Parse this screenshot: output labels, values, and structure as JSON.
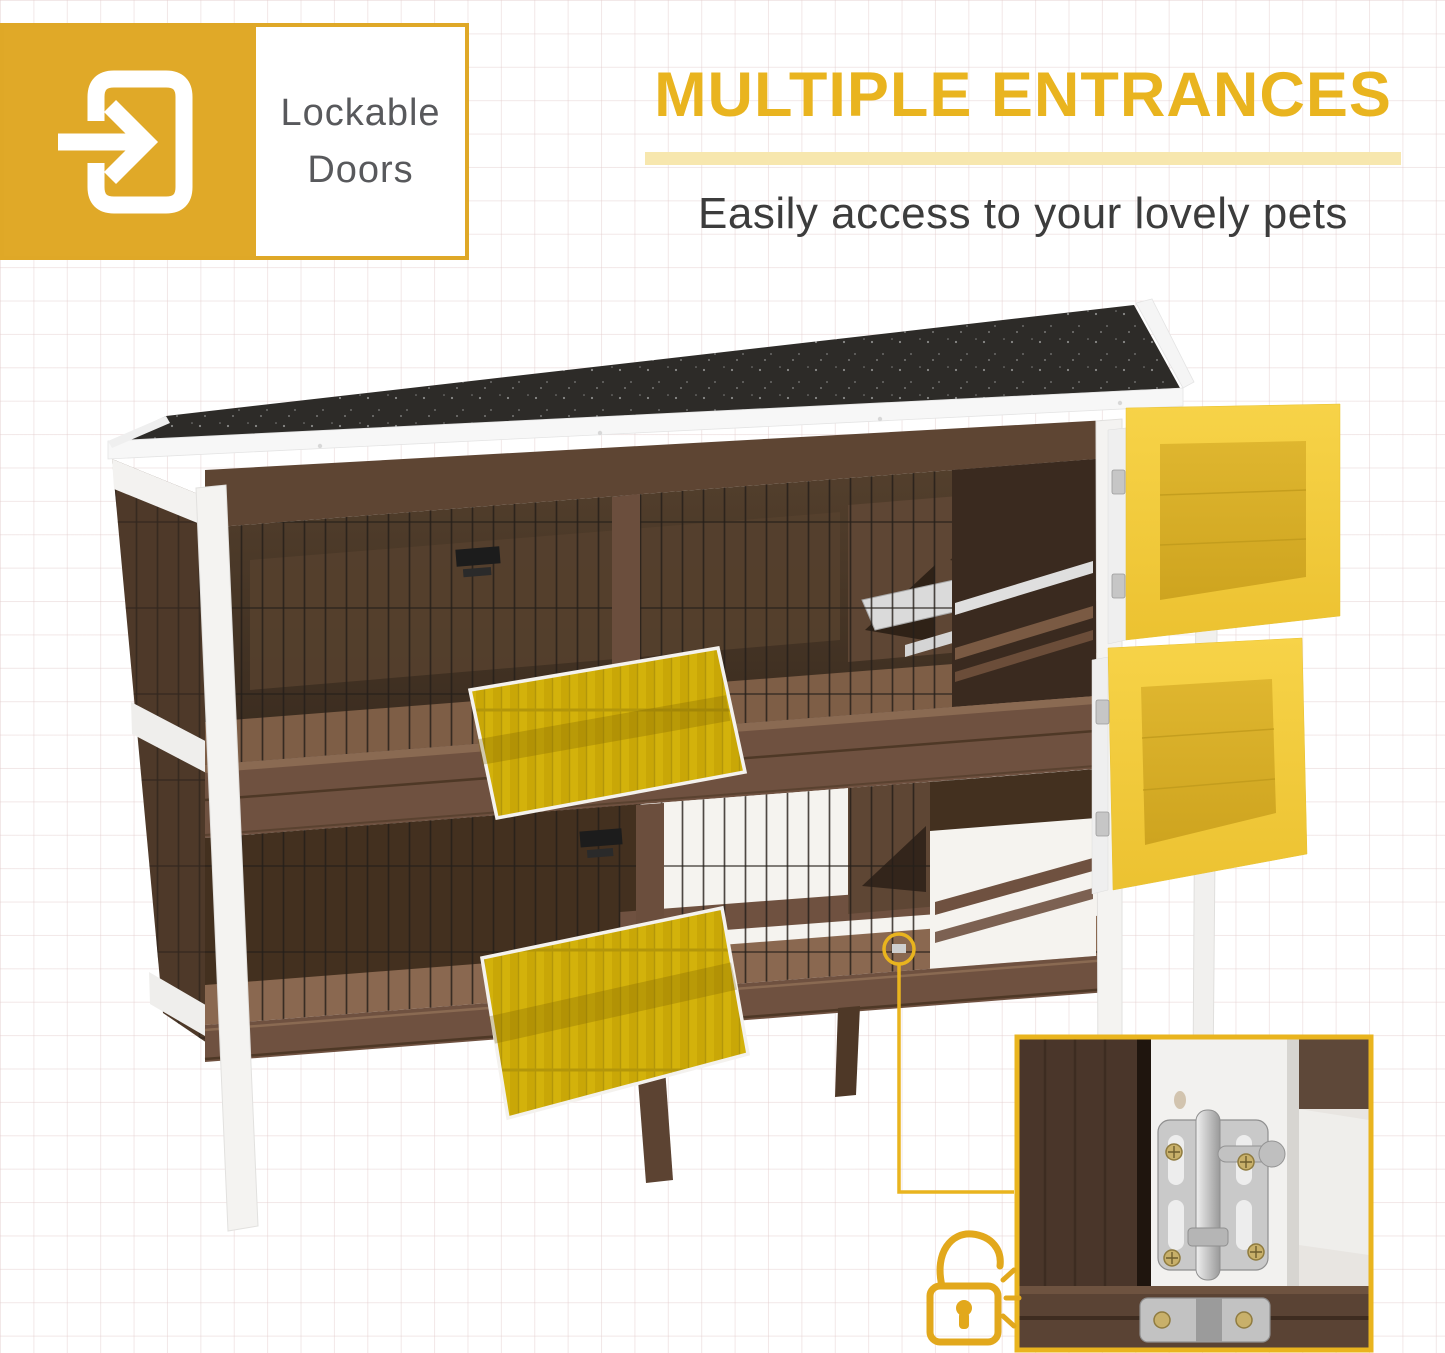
{
  "badge": {
    "line1": "Lockable",
    "line2": "Doors",
    "icon": "door-enter-arrow-icon"
  },
  "hero": {
    "title": "MULTIPLE ENTRANCES",
    "subtitle": "Easily access to your lovely pets"
  },
  "photo": {
    "subject": "two-story wooden rabbit hutch with opened doors highlighted in yellow",
    "inset": "door-lock-closeup",
    "icons": {
      "lock": "unlocked-padlock-icon",
      "callout": "callout-circle-and-line"
    }
  },
  "colors": {
    "badge_gold": "#E0A928",
    "headline_gold": "#E9B41F",
    "underline_pale_gold": "#F7E7AE",
    "subtitle_gray": "#3C3C3C",
    "label_gray": "#58595C",
    "door_highlight_yellow": "#E8C435",
    "roof_black": "#2D2B28",
    "wood_brown": "#6F5140",
    "wood_dark": "#43301F",
    "white_trim": "#F4F3F1"
  }
}
